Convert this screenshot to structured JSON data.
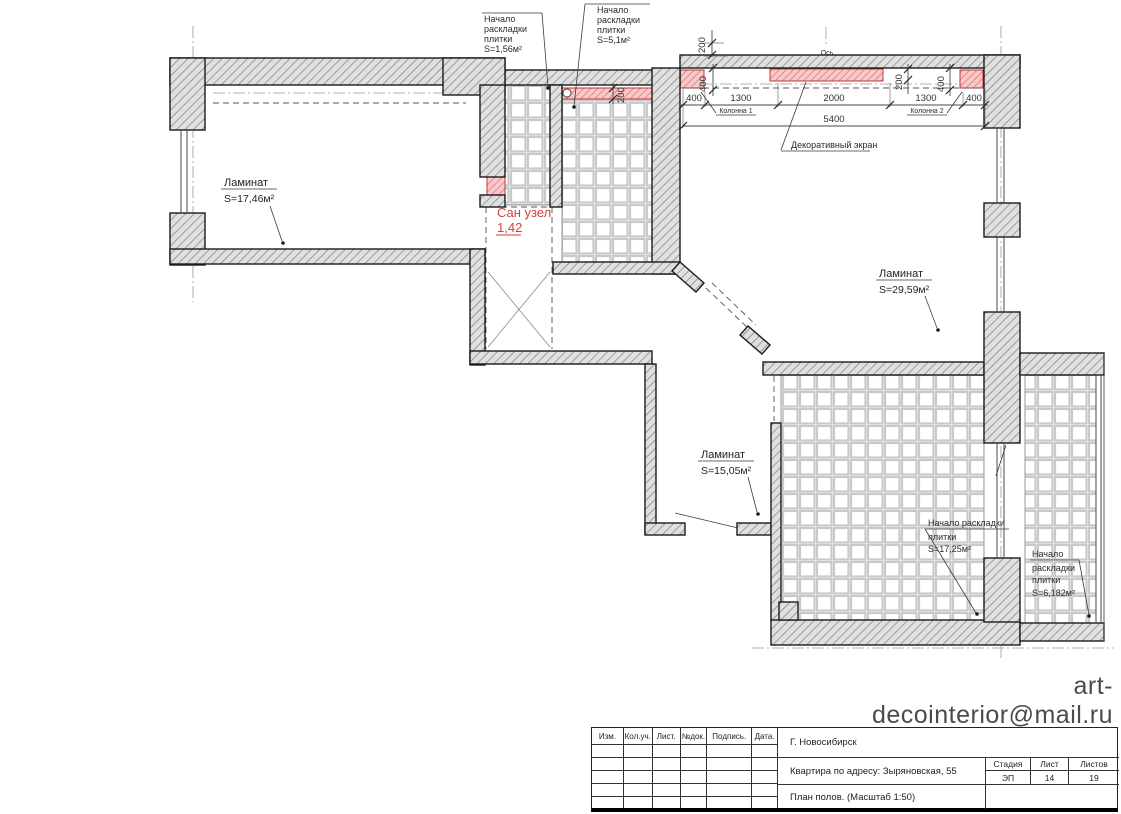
{
  "plan": {
    "labels": {
      "tile_start_bath": [
        "Начало",
        "раскладки",
        "плитки",
        "S=1,56м²"
      ],
      "tile_start_corridor": [
        "Начало",
        "раскладки",
        "плитки",
        "S=5,1м²"
      ],
      "tile_start_kitchen": [
        "Начало раскладки",
        "плитки",
        "S=17,25м²"
      ],
      "tile_start_balcony": [
        "Начало",
        "раскладки",
        "плитки",
        "S=6,182м²"
      ],
      "decorative_screen": "Декоративный экран",
      "axis": "Ось",
      "column1": "Колонна 1",
      "column2": "Колонна 2"
    },
    "rooms": {
      "room1_material": "Ламинат",
      "room1_area": "S=17,46м²",
      "living_material": "Ламинат",
      "living_area": "S=29,59м²",
      "hall_material": "Ламинат",
      "hall_area": "S=15,05м²",
      "bathroom_name": "Сан узел",
      "bathroom_area": "1,42"
    },
    "dims": {
      "chain": [
        "400",
        "1300",
        "2000",
        "1300",
        "400"
      ],
      "total": "5400",
      "v400_left": "400",
      "v400_right": "400",
      "top200": "200",
      "col200": "200",
      "strip200": "200"
    }
  },
  "email": "art-decointerior@mail.ru",
  "title_block": {
    "columns": [
      "Изм.",
      "Кол.уч.",
      "Лист.",
      "№док.",
      "Подпись.",
      "Дата."
    ],
    "city": "Г. Новосибирск",
    "project": "Квартира по адресу: Зыряновская, 55",
    "sheet_name": "План полов. (Масштаб 1:50)",
    "stage_label": "Стадия",
    "sheet_label": "Лист",
    "sheets_label": "Листов",
    "stage_value": "ЭП",
    "sheet_value": "14",
    "sheets_value": "19"
  },
  "colors": {
    "accent_red": "#d2403c",
    "wall_gray": "#e0e0e0",
    "tile_grout": "#c9c9c9",
    "email_gray": "#4b4b4b"
  }
}
